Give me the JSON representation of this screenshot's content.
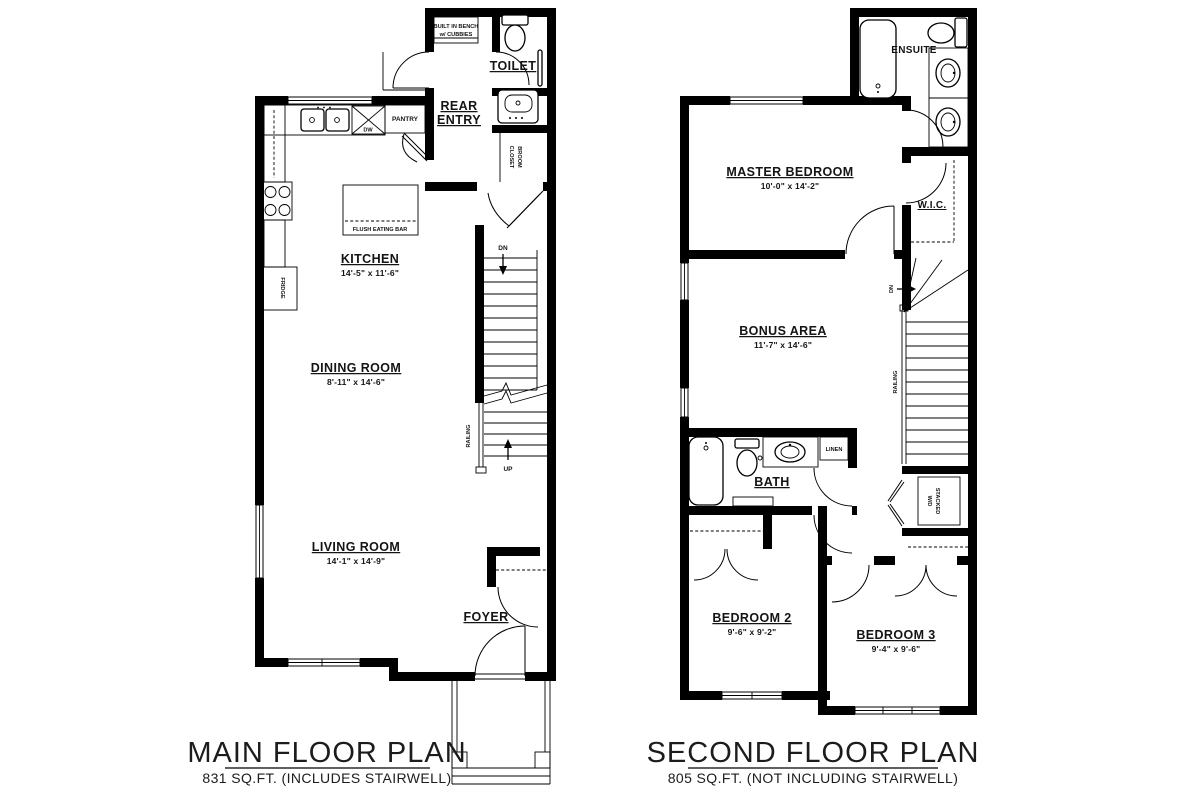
{
  "colors": {
    "background": "#ffffff",
    "line": "#000000"
  },
  "main_floor": {
    "title": "MAIN FLOOR PLAN",
    "subtitle": "831 SQ.FT. (INCLUDES STAIRWELL)",
    "rooms": {
      "kitchen": {
        "name": "KITCHEN",
        "dims": "14'-5\" x 11'-6\""
      },
      "dining_room": {
        "name": "DINING ROOM",
        "dims": "8'-11\" x 14'-6\""
      },
      "living_room": {
        "name": "LIVING ROOM",
        "dims": "14'-1\" x 14'-9\""
      },
      "foyer": {
        "name": "FOYER"
      },
      "rear_entry": {
        "line1": "REAR",
        "line2": "ENTRY"
      },
      "toilet": {
        "name": "TOILET"
      }
    },
    "labels": {
      "built_in_bench_1": "BUILT IN BENCH",
      "built_in_bench_2": "w/ CUBBIES",
      "pantry": "PANTRY",
      "dw": "DW",
      "fridge": "FRIDGE",
      "flush_eating_bar": "FLUSH EATING BAR",
      "broom_1": "BROOM",
      "broom_2": "CLOSET",
      "railing": "RAILING",
      "dn": "DN",
      "up": "UP"
    }
  },
  "second_floor": {
    "title": "SECOND FLOOR PLAN",
    "subtitle": "805 SQ.FT. (NOT INCLUDING STAIRWELL)",
    "rooms": {
      "master_bedroom": {
        "name": "MASTER BEDROOM",
        "dims": "10'-0\" x 14'-2\""
      },
      "bonus_area": {
        "name": "BONUS AREA",
        "dims": "11'-7\" x 14'-6\""
      },
      "bedroom_2": {
        "name": "BEDROOM 2",
        "dims": "9'-6\" x 9'-2\""
      },
      "bedroom_3": {
        "name": "BEDROOM 3",
        "dims": "9'-4\" x 9'-6\""
      },
      "bath": {
        "name": "BATH"
      },
      "wic": {
        "name": "W.I.C."
      },
      "ensuite": {
        "name": "ENSUITE"
      }
    },
    "labels": {
      "linen": "LINEN",
      "stacked_1": "STACKED",
      "stacked_2": "W/D",
      "railing": "RAILING",
      "dn": "DN"
    }
  }
}
